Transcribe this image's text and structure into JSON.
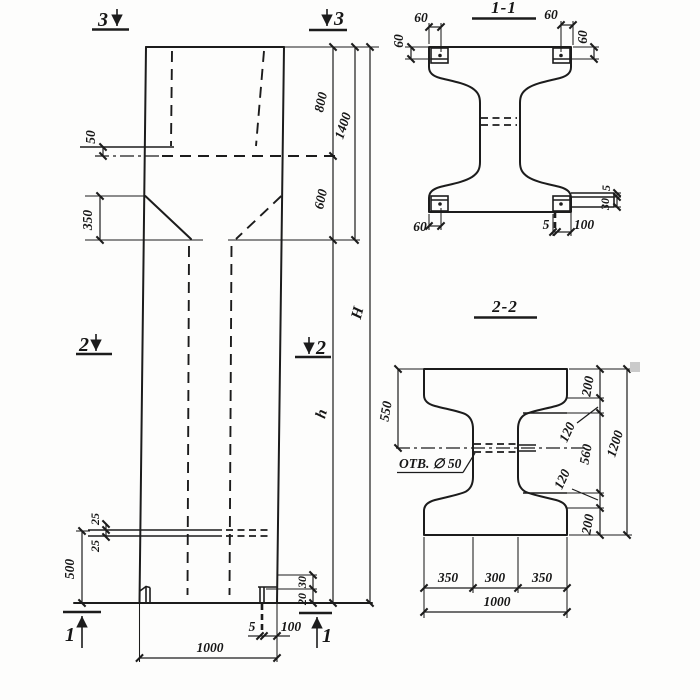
{
  "elevation": {
    "cut_markers": {
      "top": "3",
      "middle": "2",
      "bottom": "1"
    },
    "dims": {
      "flange_offset": "50",
      "haunch_height": "350",
      "top_800": "800",
      "mid_600": "600",
      "top_total_1400": "1400",
      "total_height": "H",
      "lower_height": "h",
      "plate_25_top": "25",
      "plate_25_bottom": "25",
      "base_500": "500",
      "foot_30": "30",
      "foot_20": "20",
      "foot_5": "5",
      "foot_100": "100",
      "width_1000": "1000"
    }
  },
  "section_1_1": {
    "title": "1-1",
    "dims": {
      "top_left_60": "60",
      "left_60": "60",
      "top_right_60": "60",
      "right_60": "60",
      "bottom_left_60": "60",
      "bottom_5": "5",
      "bottom_100": "100",
      "right_5": "5",
      "right_30": "30"
    }
  },
  "section_2_2": {
    "title": "2-2",
    "hole_label": "ОТВ. ∅ 50",
    "dims": {
      "left_550": "550",
      "right_200_top": "200",
      "right_120_top": "120",
      "right_560": "560",
      "right_120_bottom": "120",
      "right_200_bottom": "200",
      "right_1200": "1200",
      "bottom_350_left": "350",
      "bottom_300": "300",
      "bottom_350_right": "350",
      "bottom_1000": "1000"
    }
  }
}
